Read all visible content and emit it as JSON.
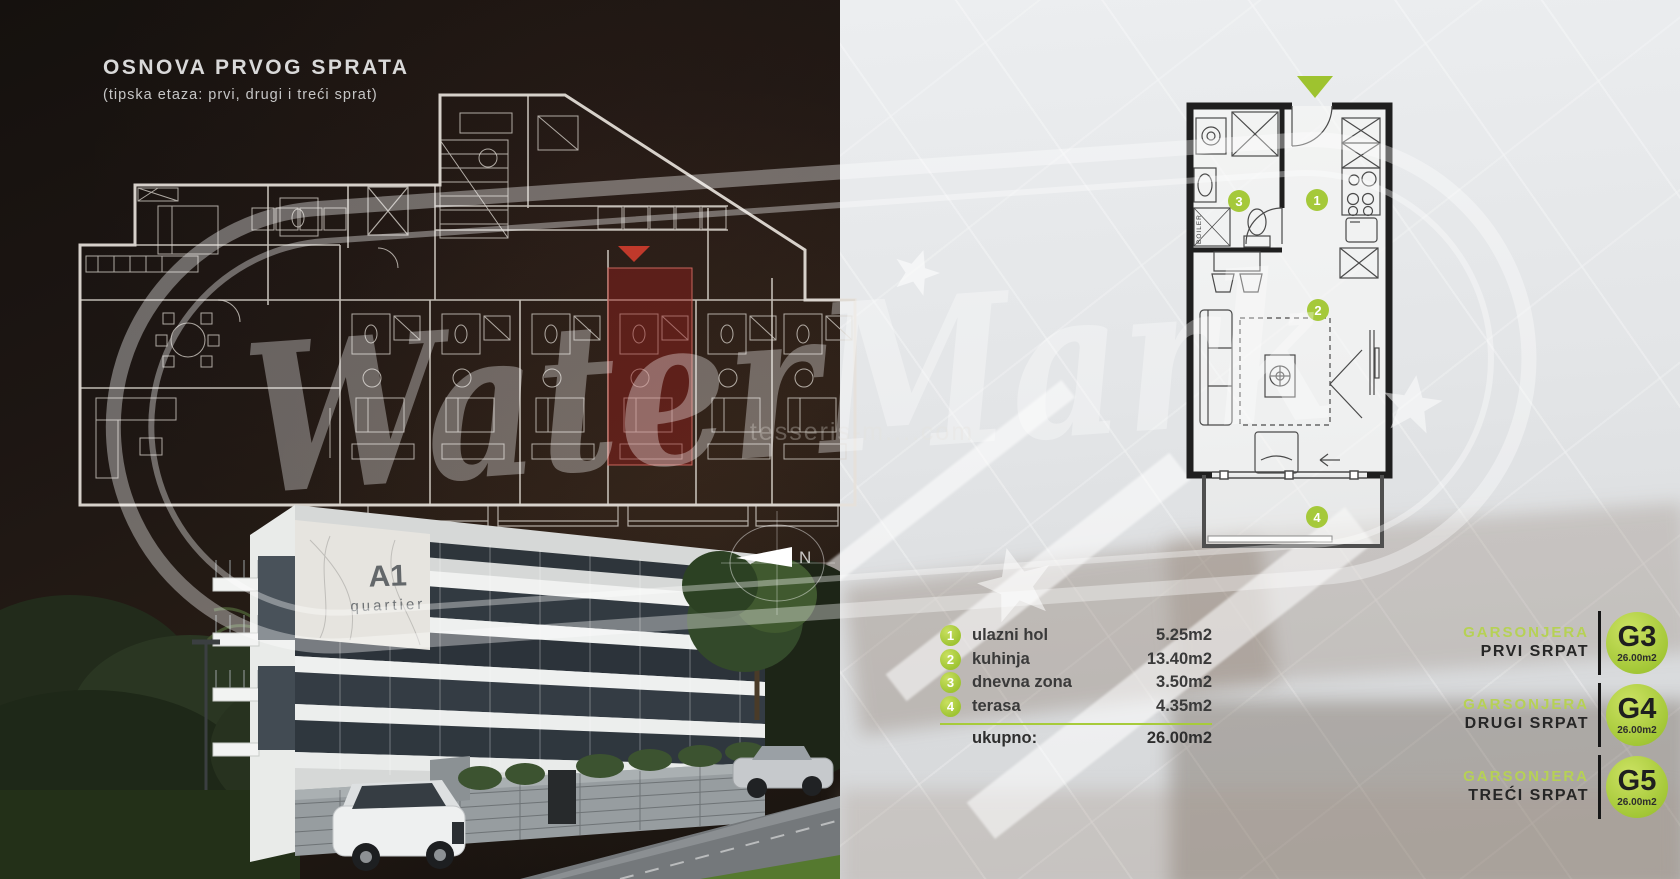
{
  "left_panel": {
    "title": "OSNOVA PRVOG SPRATA",
    "subtitle": "(tipska etaza: prvi, drugi i treći sprat)",
    "building_logo": {
      "line1": "A1",
      "line2": "quartier"
    },
    "compass_label": "N"
  },
  "floor_plan_right": {
    "boiler_label": "BOILER",
    "badges": [
      "1",
      "2",
      "3",
      "4"
    ]
  },
  "legend": {
    "rows": [
      {
        "num": "1",
        "label": "ulazni hol",
        "area": "5.25m2"
      },
      {
        "num": "2",
        "label": "kuhinja",
        "area": "13.40m2"
      },
      {
        "num": "3",
        "label": "dnevna zona",
        "area": "3.50m2"
      },
      {
        "num": "4",
        "label": "terasa",
        "area": "4.35m2"
      }
    ],
    "total_label": "ukupno:",
    "total_value": "26.00m2"
  },
  "units": [
    {
      "type": "GARSONJERA",
      "floor": "PRVI SRPAT",
      "code": "G3",
      "area": "26.00m2"
    },
    {
      "type": "GARSONJERA",
      "floor": "DRUGI SRPAT",
      "code": "G4",
      "area": "26.00m2"
    },
    {
      "type": "GARSONJERA",
      "floor": "TREĆI SRPAT",
      "code": "G5",
      "area": "26.00m2"
    }
  ],
  "watermark": {
    "big": "WaterMark",
    "small": "tesseris-m....com"
  },
  "colors": {
    "accent_green": "#a6c93b",
    "badge_green": "#9fc433",
    "highlight_red": "#9b2d26",
    "dark_bg": "#1a1410",
    "light_bg": "#e3e5e7"
  }
}
